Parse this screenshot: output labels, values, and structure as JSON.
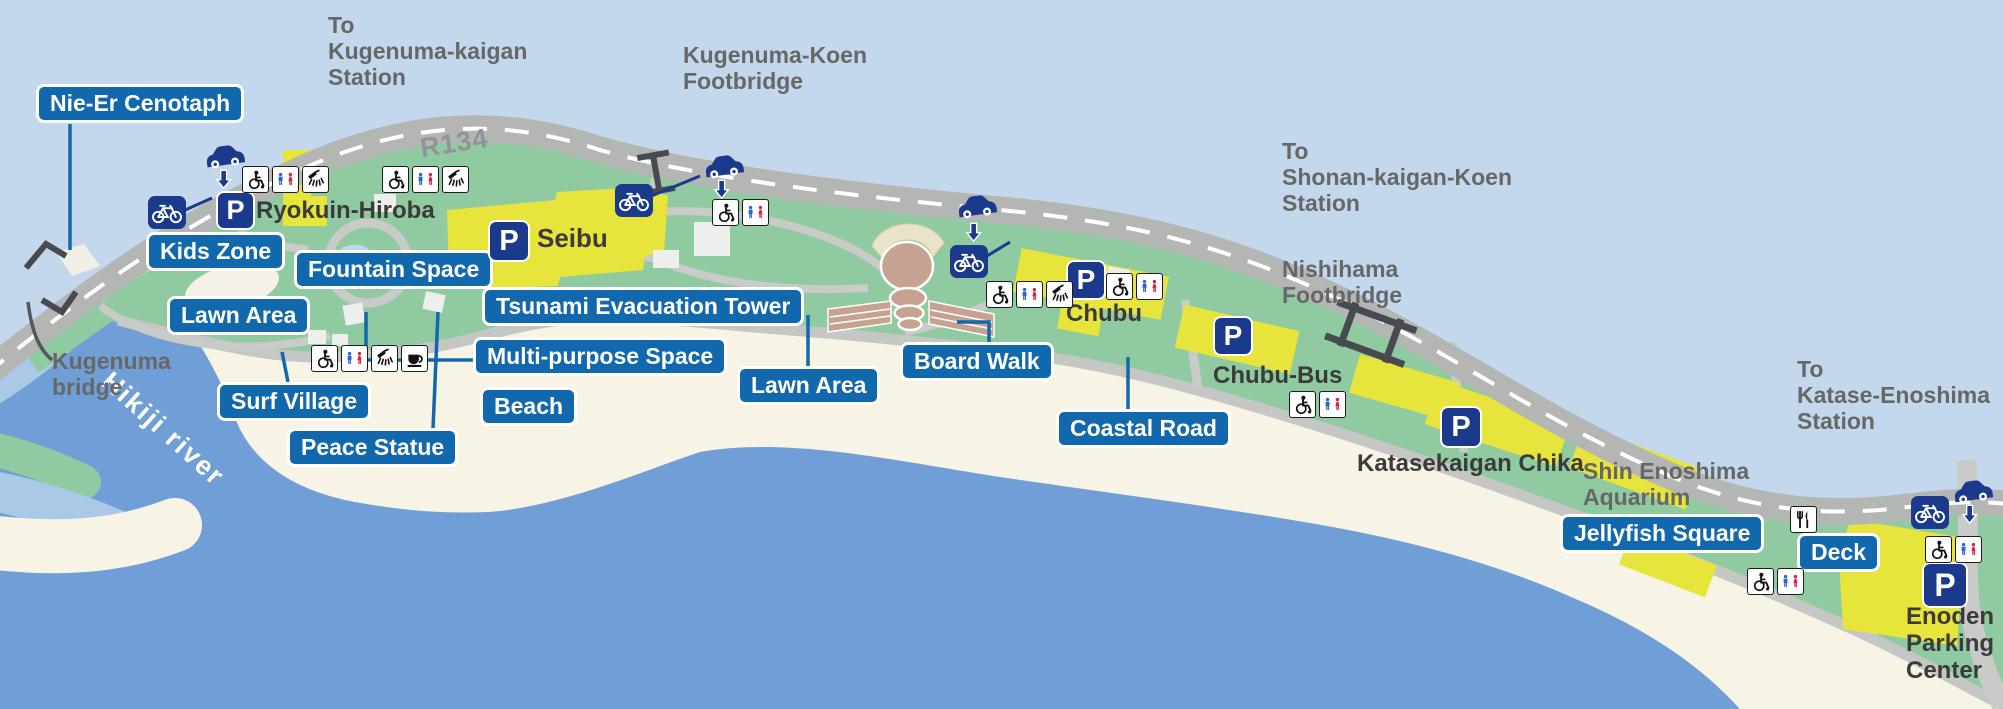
{
  "map_title": "Shonan coastal park guide map",
  "labels": {
    "blue": [
      {
        "id": "nie_er_cenotaph",
        "text": "Nie-Er Cenotaph"
      },
      {
        "id": "kids_zone",
        "text": "Kids Zone"
      },
      {
        "id": "fountain_space",
        "text": "Fountain Space"
      },
      {
        "id": "lawn_area_west",
        "text": "Lawn Area"
      },
      {
        "id": "surf_village",
        "text": "Surf Village"
      },
      {
        "id": "peace_statue",
        "text": "Peace Statue"
      },
      {
        "id": "tsunami_evacuation_tower",
        "text": "Tsunami Evacuation Tower"
      },
      {
        "id": "multi_purpose_space",
        "text": "Multi-purpose Space"
      },
      {
        "id": "beach",
        "text": "Beach"
      },
      {
        "id": "lawn_area_center",
        "text": "Lawn Area"
      },
      {
        "id": "board_walk",
        "text": "Board Walk"
      },
      {
        "id": "coastal_road",
        "text": "Coastal Road"
      },
      {
        "id": "jellyfish_square",
        "text": "Jellyfish Square"
      },
      {
        "id": "deck",
        "text": "Deck"
      }
    ],
    "directions": {
      "to_kugenuma_kaigan_station": "To\nKugenuma-kaigan\nStation",
      "kugenuma_koen_footbridge": "Kugenuma-Koen\nFootbridge",
      "to_shonan_kaigan_koen_station": "To\nShonan-kaigan-Koen\nStation",
      "nishihama_footbridge": "Nishihama\nFootbridge",
      "to_katase_enoshima_station": "To\nKatase-Enoshima\nStation",
      "kugenuma_bridge": "Kugenuma\nbridge",
      "shin_enoshima_aquarium": "Shin Enoshima\nAquarium"
    },
    "facilities": {
      "ryokuin_hiroba": "Ryokuin-Hiroba",
      "seibu": "Seibu",
      "chubu": "Chubu",
      "chubu_bus": "Chubu-Bus",
      "katasekaigan_chika": "Katasekaigan Chika",
      "enoden_parking_center": "Enoden\nParking\nCenter"
    },
    "road": "R134",
    "river": "Hikiji river"
  },
  "icons": {
    "parking_glyph": "P",
    "types": [
      "parking-icon",
      "bicycle-icon",
      "car-entrance-icon",
      "wheelchair-icon",
      "restroom-icon",
      "shower-icon",
      "cafe-icon",
      "restaurant-icon",
      "footbridge-icon"
    ]
  },
  "colors": {
    "label_blue": "#1168ac",
    "icon_navy": "#1b3a8c",
    "park_green": "#8fcaa0",
    "water_blue": "#6f9fd6",
    "shallow_blue": "#abc8e6",
    "sky_blue": "#c3d8ec",
    "beach_cream": "#f7f4e6",
    "building_yellow": "#e7e43c",
    "road_gray": "#b4b6b4",
    "restroom_man_blue": "#2766c8",
    "restroom_woman_red": "#dd1f3e"
  }
}
